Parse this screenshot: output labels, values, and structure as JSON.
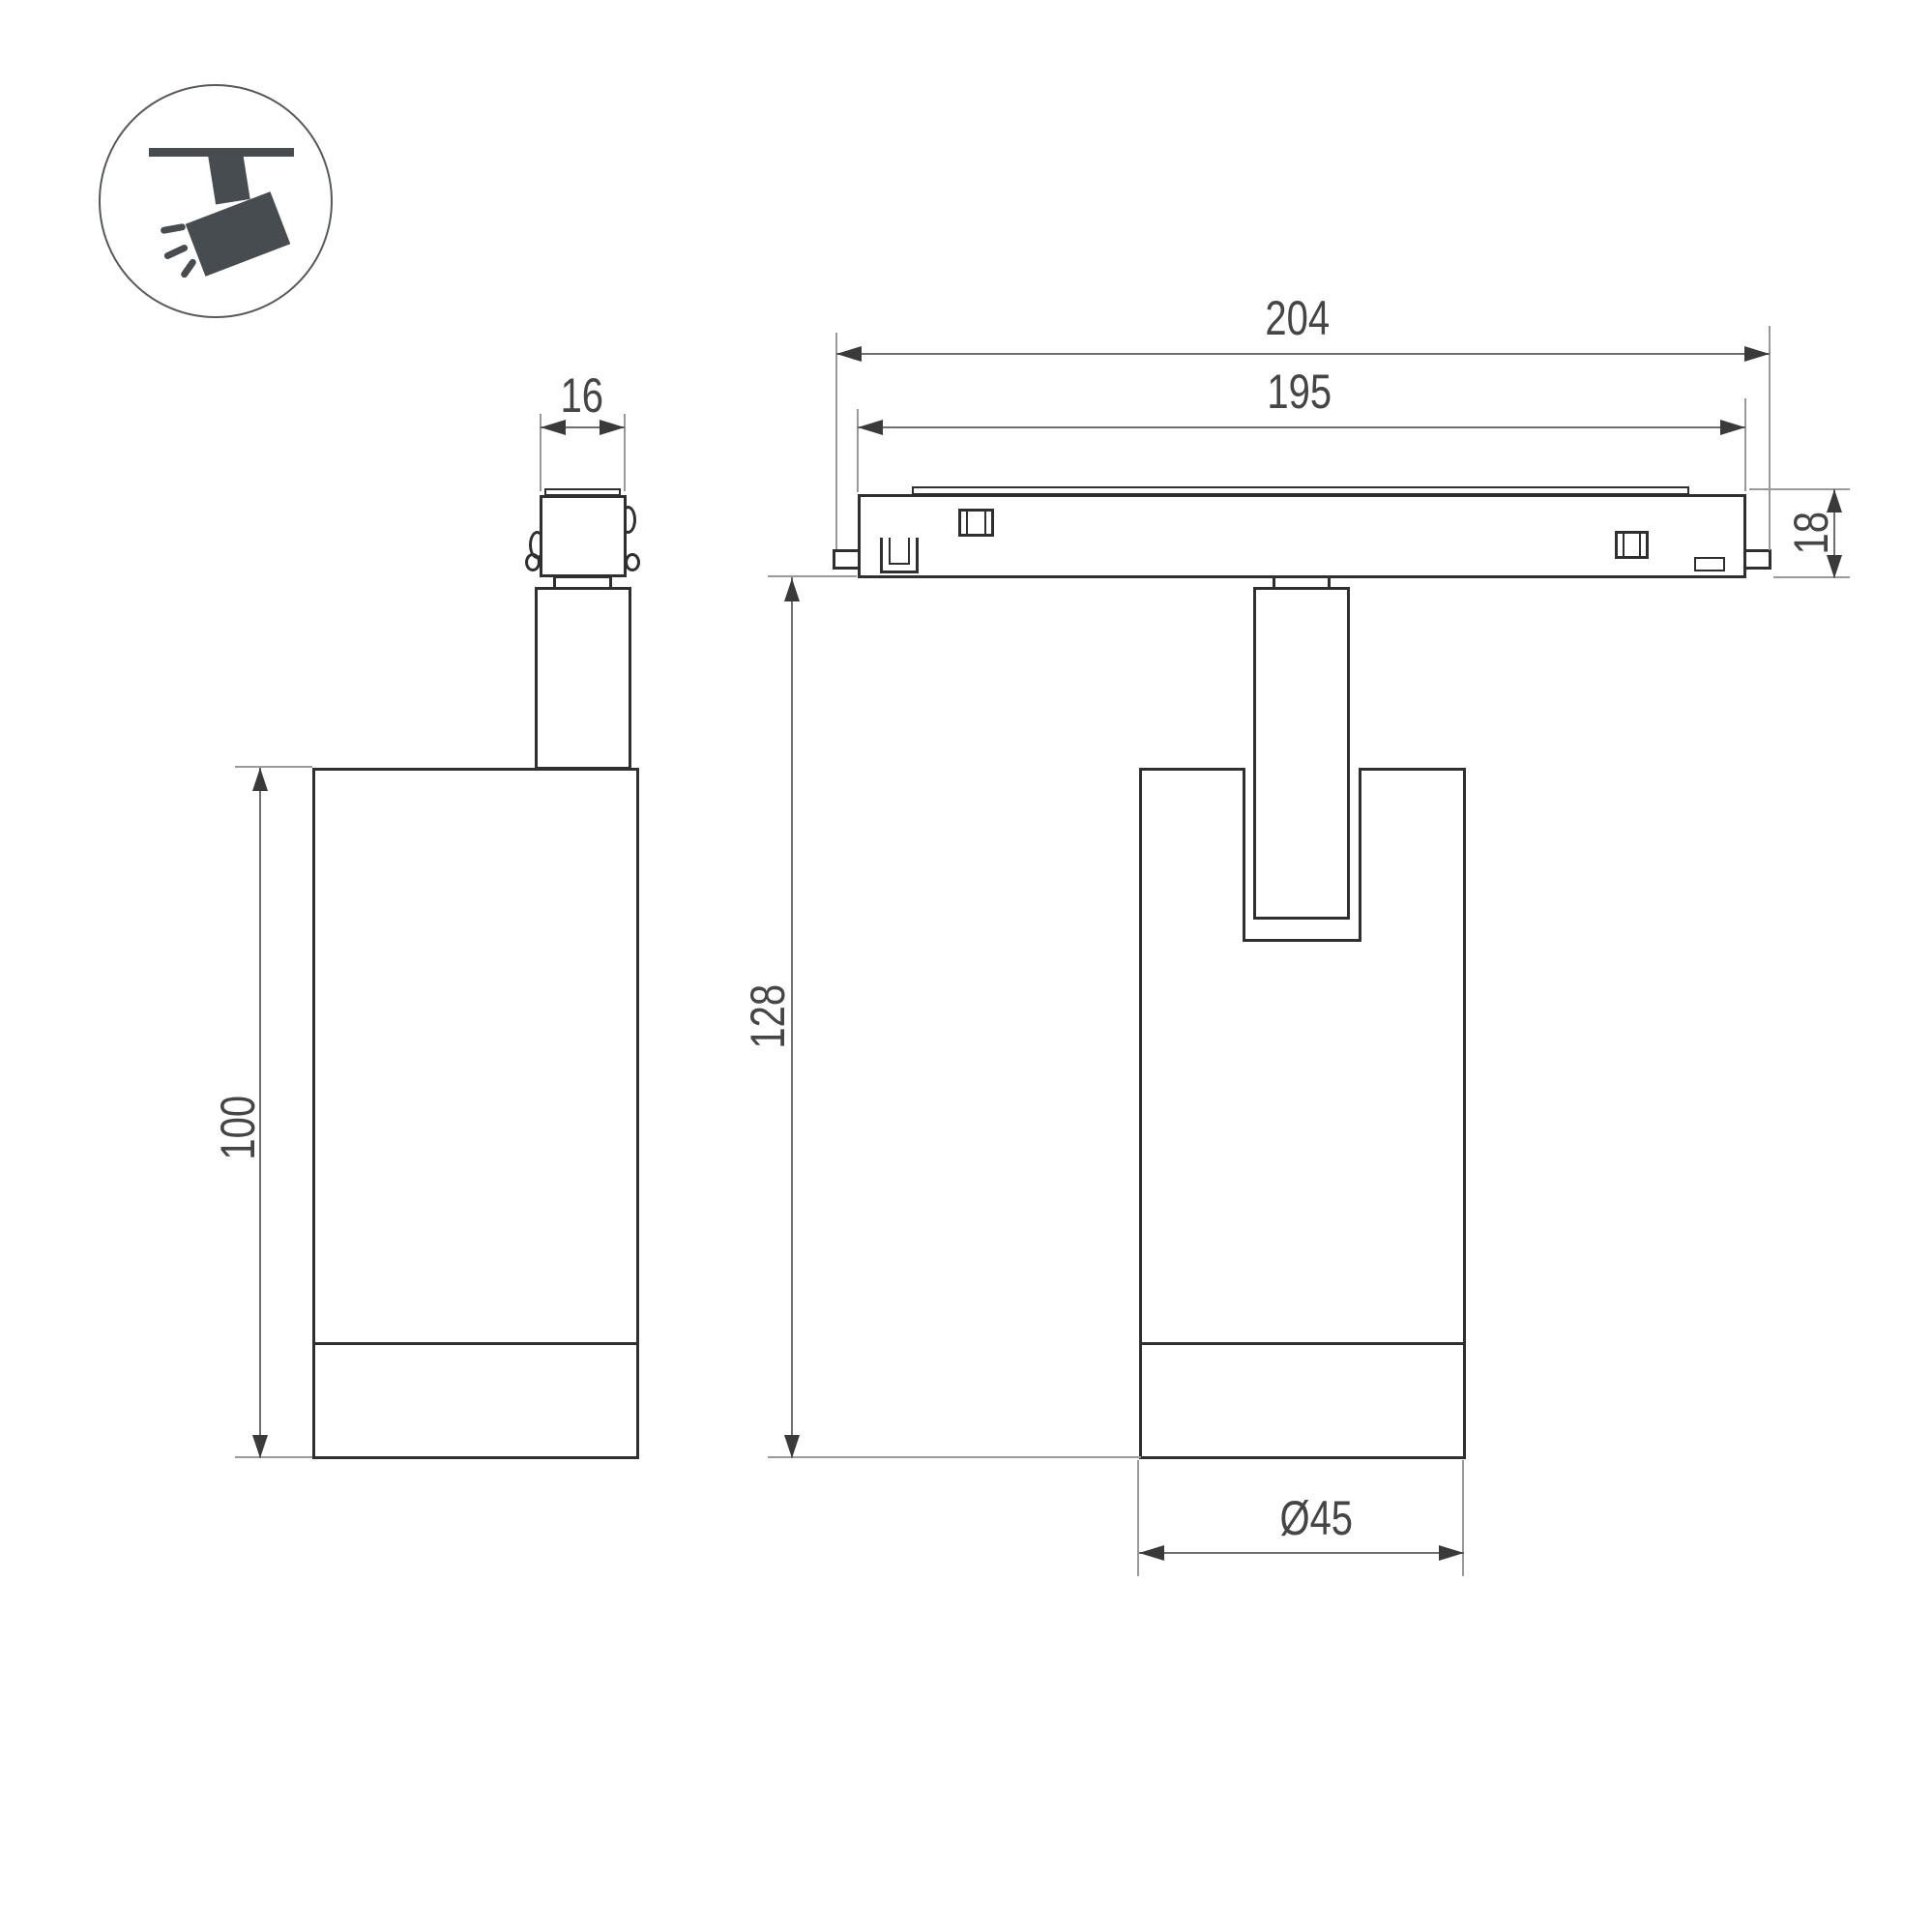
{
  "drawing": {
    "kind": "technical-dimension-drawing",
    "subject": "magnetic track spot light, side view and front view"
  },
  "icon": {
    "name": "ceiling-track-spotlight-pictogram"
  },
  "dims": {
    "connector_width": "16",
    "track_overall_length": "204",
    "track_inner_length": "195",
    "track_height": "18",
    "overall_drop_height": "128",
    "body_height": "100",
    "body_diameter": "Ø45"
  },
  "colors": {
    "outline": "#2f2f2f",
    "dimension_line": "#6f6f6f",
    "extension_line": "#9a9a9a",
    "text": "#454545",
    "icon_fill": "#474c51",
    "background": "#ffffff"
  }
}
